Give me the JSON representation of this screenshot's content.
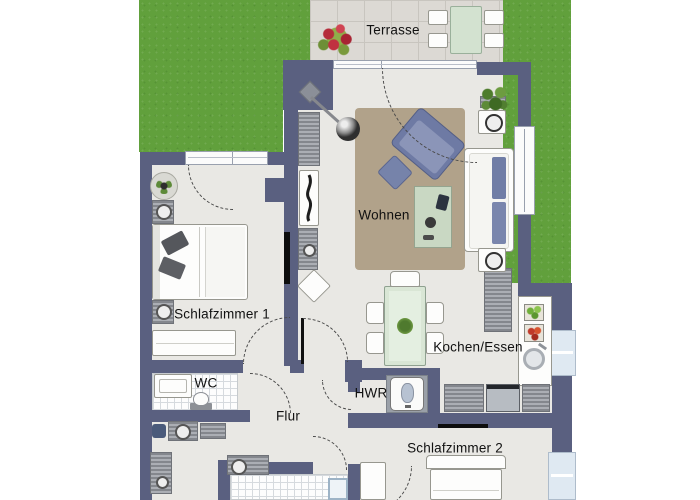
{
  "plan": {
    "title": "Wohnung Grundriss",
    "rooms": {
      "terrasse": {
        "label": "Terrasse"
      },
      "wohnen": {
        "label": "Wohnen"
      },
      "schlafzimmer1": {
        "label": "Schlafzimmer 1"
      },
      "kochen_essen": {
        "label": "Kochen/Essen"
      },
      "wc": {
        "label": "WC"
      },
      "flur": {
        "label": "Flur"
      },
      "hwr": {
        "label": "HWR"
      },
      "schlafzimmer2": {
        "label": "Schlafzimmer 2"
      }
    },
    "colors": {
      "wall": "#5a6080",
      "grass": "#61a03c",
      "terrace_paving": "#dcd9d4",
      "floor": "#e9e8e4",
      "carpet": "#b1a28a",
      "sofa_blue": "#6e7aa4",
      "dining_table_green": "#d9e6d5",
      "tile_white": "#fdfdfd",
      "label_text": "#111111"
    }
  }
}
